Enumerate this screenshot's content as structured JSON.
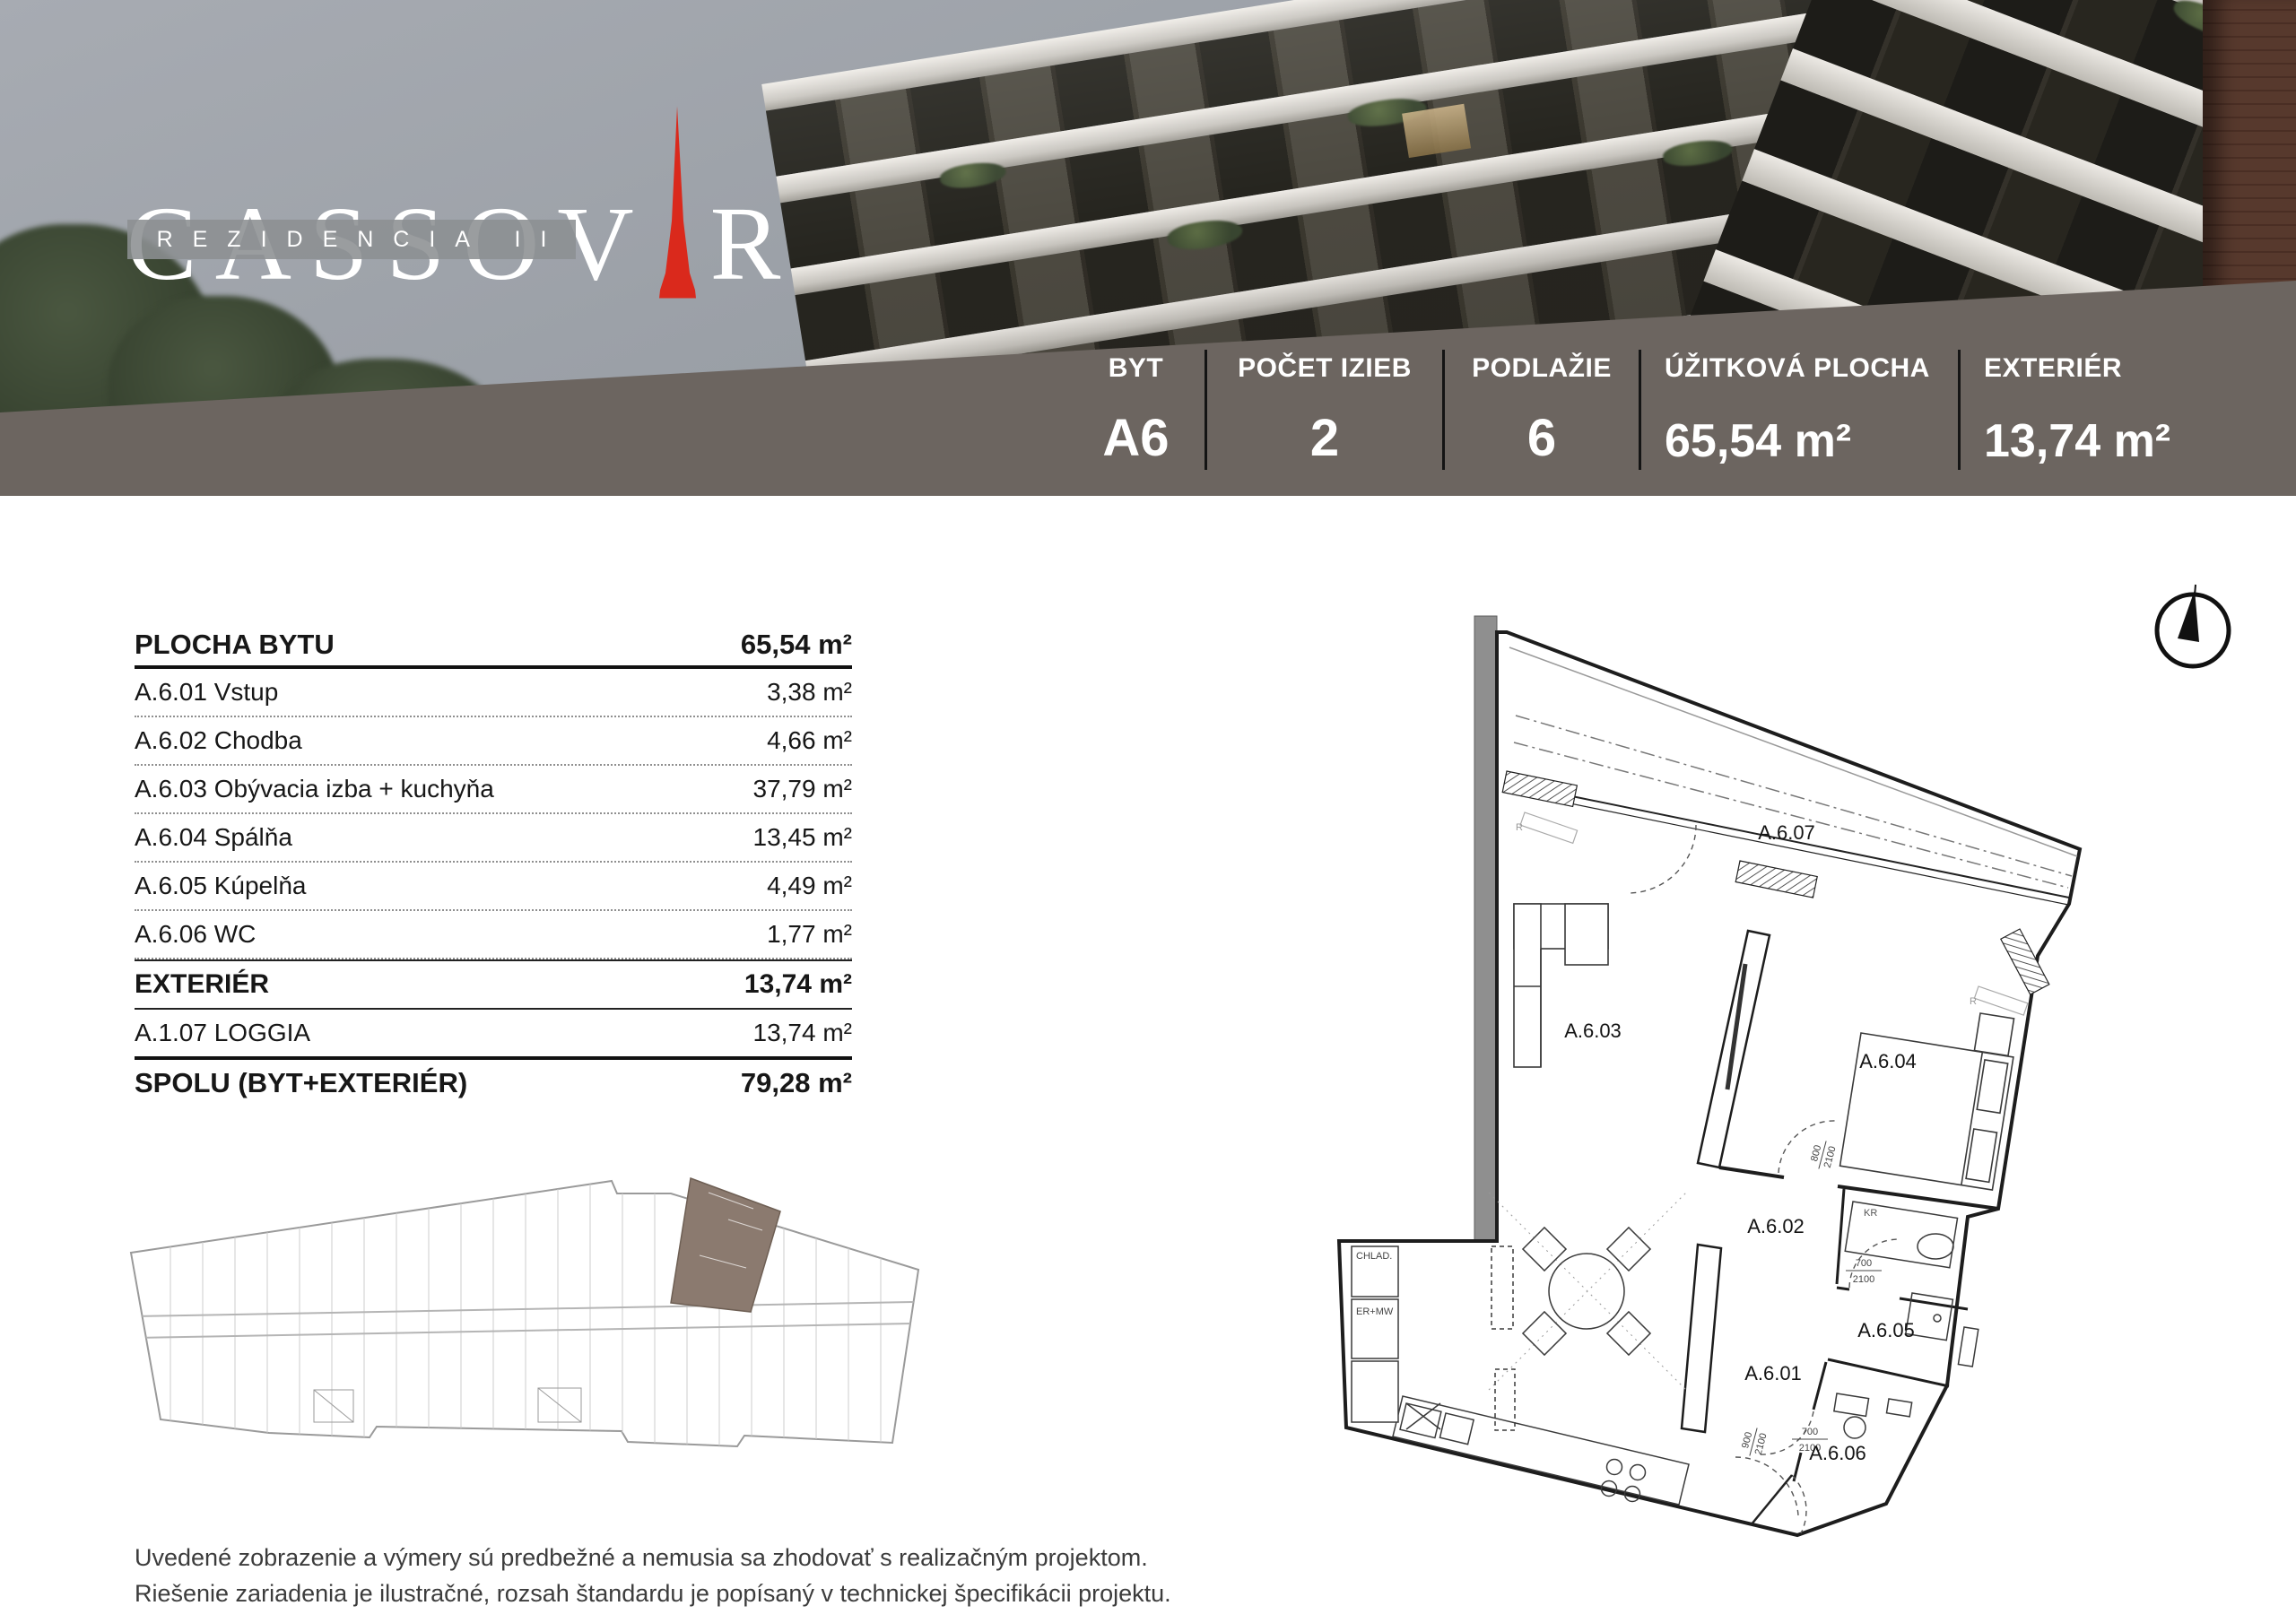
{
  "brand": {
    "word_left": "CASSOV",
    "word_right": "R",
    "subtitle": "REZIDENCIA II"
  },
  "summary_bar": {
    "cells": [
      {
        "label": "BYT",
        "value": "A6"
      },
      {
        "label": "POČET IZIEB",
        "value": "2"
      },
      {
        "label": "PODLAŽIE",
        "value": "6"
      },
      {
        "label": "ÚŽITKOVÁ PLOCHA",
        "value": "65,54 m²"
      },
      {
        "label": "EXTERIÉR",
        "value": "13,74 m²"
      }
    ]
  },
  "area_table": {
    "header": {
      "label": "PLOCHA BYTU",
      "value": "65,54 m²"
    },
    "rows": [
      {
        "label": "A.6.01 Vstup",
        "value": "3,38 m²"
      },
      {
        "label": "A.6.02 Chodba",
        "value": "4,66 m²"
      },
      {
        "label": "A.6.03 Obývacia izba + kuchyňa",
        "value": "37,79 m²"
      },
      {
        "label": "A.6.04 Spálňa",
        "value": "13,45 m²"
      },
      {
        "label": "A.6.05 Kúpelňa",
        "value": "4,49 m²"
      },
      {
        "label": "A.6.06 WC",
        "value": "1,77 m²"
      }
    ],
    "exterior": {
      "label": "EXTERIÉR",
      "value": "13,74 m²"
    },
    "exterior_rows": [
      {
        "label": "A.1.07 LOGGIA",
        "value": "13,74 m²"
      }
    ],
    "total": {
      "label": "SPOLU (BYT+EXTERIÉR)",
      "value": "79,28 m²"
    }
  },
  "floor_plan": {
    "rooms": {
      "loggia": "A.6.07",
      "living": "A.6.03",
      "bedroom": "A.6.04",
      "hall": "A.6.02",
      "bath": "A.6.05",
      "entry": "A.6.01",
      "wc": "A.6.06"
    },
    "labels": {
      "fridge": "CHLAD.",
      "oven": "ER+MW",
      "wardrobe": "KR",
      "radiator": "R"
    },
    "dims": {
      "d800": "800",
      "d700": "700",
      "d900": "900",
      "d2100": "2100"
    }
  },
  "disclaimer": {
    "line1": "Uvedené zobrazenie a výmery sú predbežné a nemusia sa zhodovať s realizačným projektom.",
    "line2": "Riešenie zariadenia je ilustračné, rozsah štandardu je popísaný v technickej špecifikácii projektu."
  },
  "colors": {
    "band_brown": "#6c6560",
    "logo_red": "#da291c",
    "plan_highlight": "#8b7a6f"
  }
}
